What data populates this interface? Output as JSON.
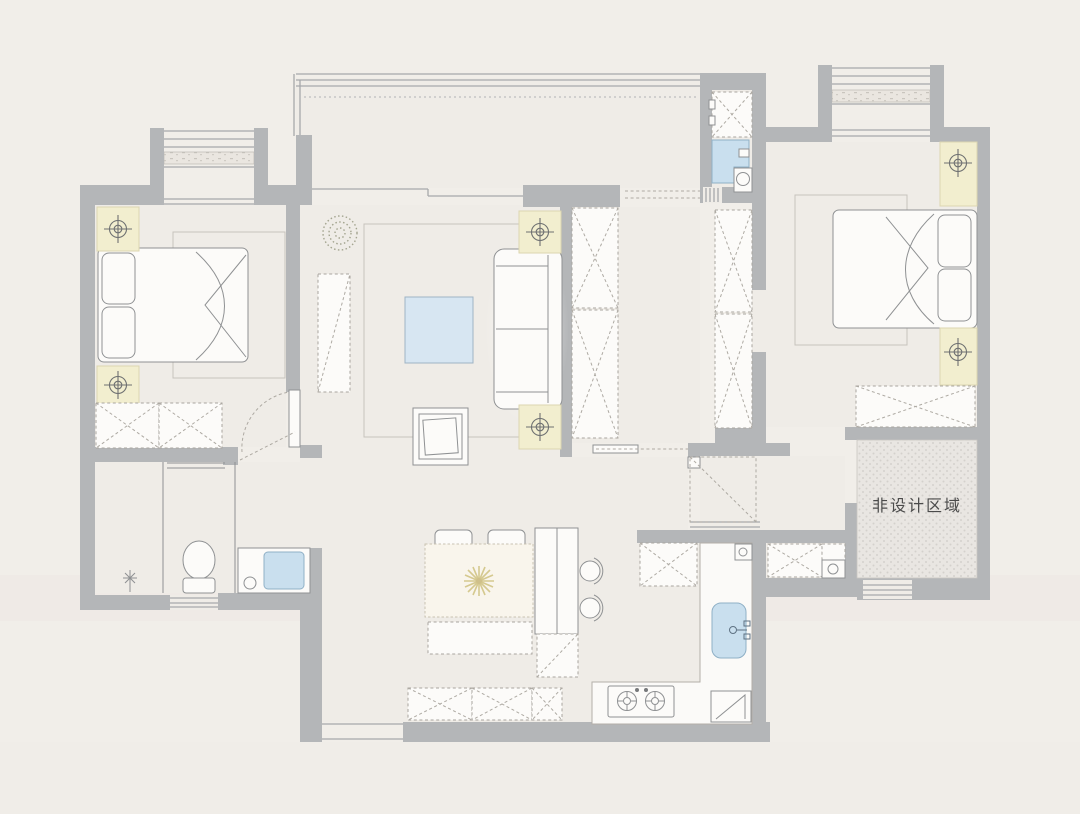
{
  "page": {
    "title": "Floor Plan"
  },
  "plan": {
    "labels": {
      "non_design_area": "非设计区域"
    },
    "icons": {
      "ceiling_light": "crosshair-target-symbol",
      "floor_drain": "asterisk-star-symbol",
      "plant": "dotted-circle-plant-symbol",
      "table_flower": "starburst-flower-symbol"
    },
    "colors": {
      "background": "#f1eee9",
      "floor": "#efece7",
      "wall": "#b4b6b8",
      "line": "#8f9193",
      "line_light": "#c7c3bd",
      "window_line": "#a7a9ab",
      "furniture_fill": "#fcfbf9",
      "accent_blue": "#c9dfee",
      "accent_blue_stroke": "#8fb0c6",
      "lamp_yellow": "#f2eecf",
      "lamp_stroke": "#6e7071",
      "hatch_floor": "#e9e6e2",
      "hatch_dot": "#d4d1cc",
      "plant_green": "#a3a48f",
      "flower_yellow": "#d5c98f"
    }
  }
}
